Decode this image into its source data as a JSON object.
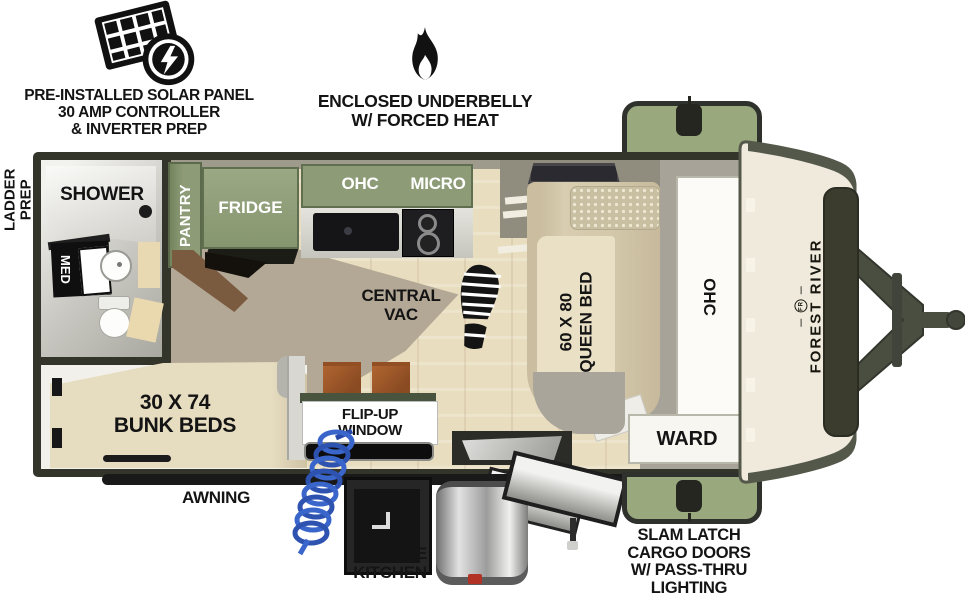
{
  "annotations": {
    "solar": {
      "lines": [
        "PRE-INSTALLED SOLAR PANEL",
        "30 AMP CONTROLLER",
        "& INVERTER PREP"
      ]
    },
    "underbelly": {
      "lines": [
        "ENCLOSED UNDERBELLY",
        "W/ FORCED HEAT"
      ]
    },
    "ladder_prep": {
      "lines": [
        "LADDER",
        "PREP"
      ]
    },
    "awning_label": "AWNING",
    "outside_kitchen": {
      "lines": [
        "OUTSIDE",
        "KITCHEN"
      ]
    },
    "cargo_doors": {
      "lines": [
        "SLAM LATCH",
        "CARGO DOORS",
        "W/ PASS-THRU",
        "LIGHTING"
      ]
    }
  },
  "interior_labels": {
    "shower": "SHOWER",
    "med": "MED",
    "pantry": "PANTRY",
    "fridge": "FRIDGE",
    "ohc_kitchen": "OHC",
    "micro": "MICRO",
    "central_vac": {
      "lines": [
        "CENTRAL",
        "VAC"
      ]
    },
    "queen_bed": {
      "lines": [
        "60 X 80",
        "QUEEN BED"
      ]
    },
    "ohc_wardrobe": "OHC",
    "ward": "WARD",
    "bunk_beds": {
      "lines": [
        "30 X 74",
        "BUNK BEDS"
      ]
    },
    "flip_up_window": {
      "lines": [
        "FLIP-UP",
        "WINDOW"
      ]
    }
  },
  "brand": {
    "name": "FOREST RIVER",
    "monogram": "FR"
  },
  "icons": [
    "solar-panel-icon",
    "lightning-bolt-icon",
    "flame-icon",
    "boot-print-icon",
    "coiled-hose-icon",
    "cargo-door-handle-icon"
  ],
  "colors": {
    "cabinet_green": "#8d9c77",
    "cargo_door_green": "#9aa87e",
    "wall_dark": "#33352b",
    "floor_wood": "#e9ddc0",
    "mattress_beige": "#d8cdb0",
    "front_cap_cream": "#efeadb",
    "hose_blue": "#3a66cc",
    "stool_rust": "#a2582a",
    "valve_red": "#b33226"
  }
}
